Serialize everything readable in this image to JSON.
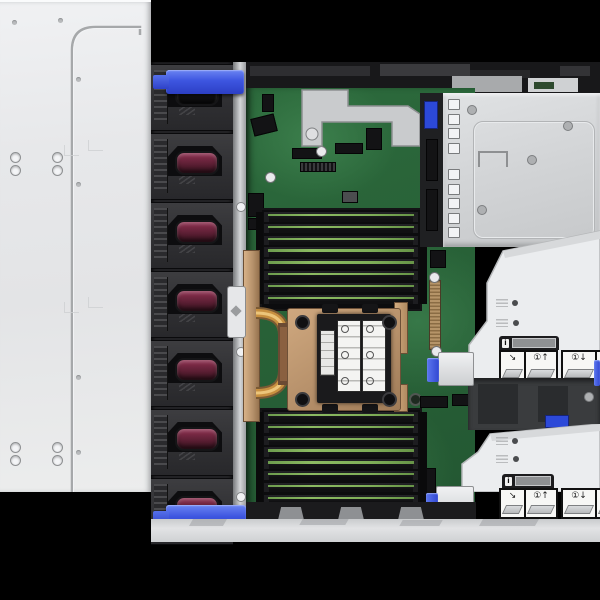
{
  "meta": {
    "subject": "Top-down interior view of a 2U rack server with top cover slid off",
    "visible_text": "none-legible"
  },
  "palette": {
    "background_black": "#000000",
    "top_cover_gray": "#e8e9eb",
    "fan_cage_dark": "#222225",
    "fan_face_gray": "#39393c",
    "fan_handle_maroon": "#8e3050",
    "fan_handle_black": "#1b1b1e",
    "touchpoint_blue": "#3d55e0",
    "pcb_green": "#2c6a3c",
    "dimm_slot_black": "#121214",
    "dimm_edge_green": "#7fae58",
    "heatsink_bronze": "#bf9a76",
    "heatpipe_copper": "#c89040",
    "psu_tray_silver": "#d6d8da",
    "air_baffle_white": "#ebedef",
    "service_label_white": "#f7f7f5",
    "bay_dark": "#3a3c3e"
  },
  "top_cover": {
    "name": "server-top-cover",
    "screw_hole_clusters": 2,
    "holes_per_cluster": 4
  },
  "fan_bay": {
    "fan_count": 7,
    "fan_handles": [
      "#1b1b1e",
      "#8e3050",
      "#8e3050",
      "#8e3050",
      "#8e3050",
      "#8e3050",
      "#8e3050"
    ],
    "top_handle_name": "fan-cage-release-handle-top",
    "bottom_handle_name": "fan-cage-release-handle-bottom",
    "rail_screws": 3
  },
  "memory": {
    "banks": [
      {
        "name": "dimm-bank-top",
        "dimm_count": 8
      },
      {
        "name": "dimm-bank-bottom",
        "dimm_count": 8
      }
    ]
  },
  "processor": {
    "heatsink": "bronze-copper heatsink with heat pipes",
    "service_label_count": 2
  },
  "psu_tray": {
    "vent_groups": [
      4,
      5
    ]
  },
  "service_labels": {
    "rows": 2,
    "header_glyph": "i",
    "panels": [
      {
        "name": "service-label-unhook-icon",
        "glyph": "↘",
        "width": 23,
        "group": 1
      },
      {
        "name": "service-label-lift-icon",
        "glyph": "①↑",
        "width": 30,
        "group": 1
      },
      {
        "name": "service-label-insert-icon",
        "glyph": "①↓",
        "width": 32,
        "group": 2
      },
      {
        "name": "service-label-hook-icon",
        "glyph": "↩",
        "width": 15,
        "group": 2
      }
    ]
  }
}
